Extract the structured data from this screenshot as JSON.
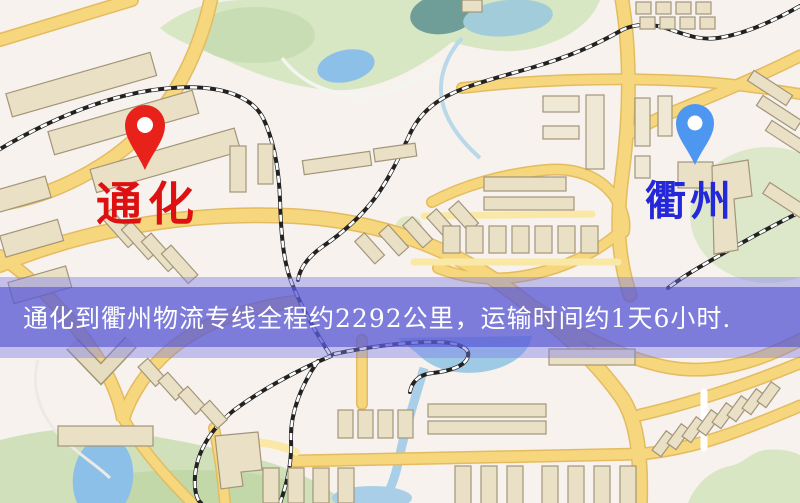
{
  "banner": {
    "text": "通化到衢州物流专线全程约2292公里，运输时间约1天6小时.",
    "background_color": "#5a5ad2",
    "text_color": "#ffffff"
  },
  "markers": {
    "origin": {
      "label": "通化",
      "pin_color": "#e8221a",
      "pin_hole_color": "#ffffff",
      "label_color": "#dd1111"
    },
    "destination": {
      "label": "衢州",
      "pin_color": "#4e97f0",
      "pin_hole_color": "#ffffff",
      "label_color": "#2428d8"
    }
  },
  "map_palette": {
    "background": "#f7f2ed",
    "road_major": "#f6d77e",
    "road_casing": "#e4bb60",
    "road_minor": "#fae8a6",
    "road_white": "#ffffff",
    "building_fill": "#e9e0c6",
    "building_stroke": "#a3957a",
    "park": "#d7e6c3",
    "park_dark": "#c8dcb0",
    "water": "#8fc2e6",
    "lake_teal": "#6f9e98",
    "lake_light": "#a3ccdb",
    "railway_dark": "#222222",
    "railway_light": "#ffffff"
  }
}
